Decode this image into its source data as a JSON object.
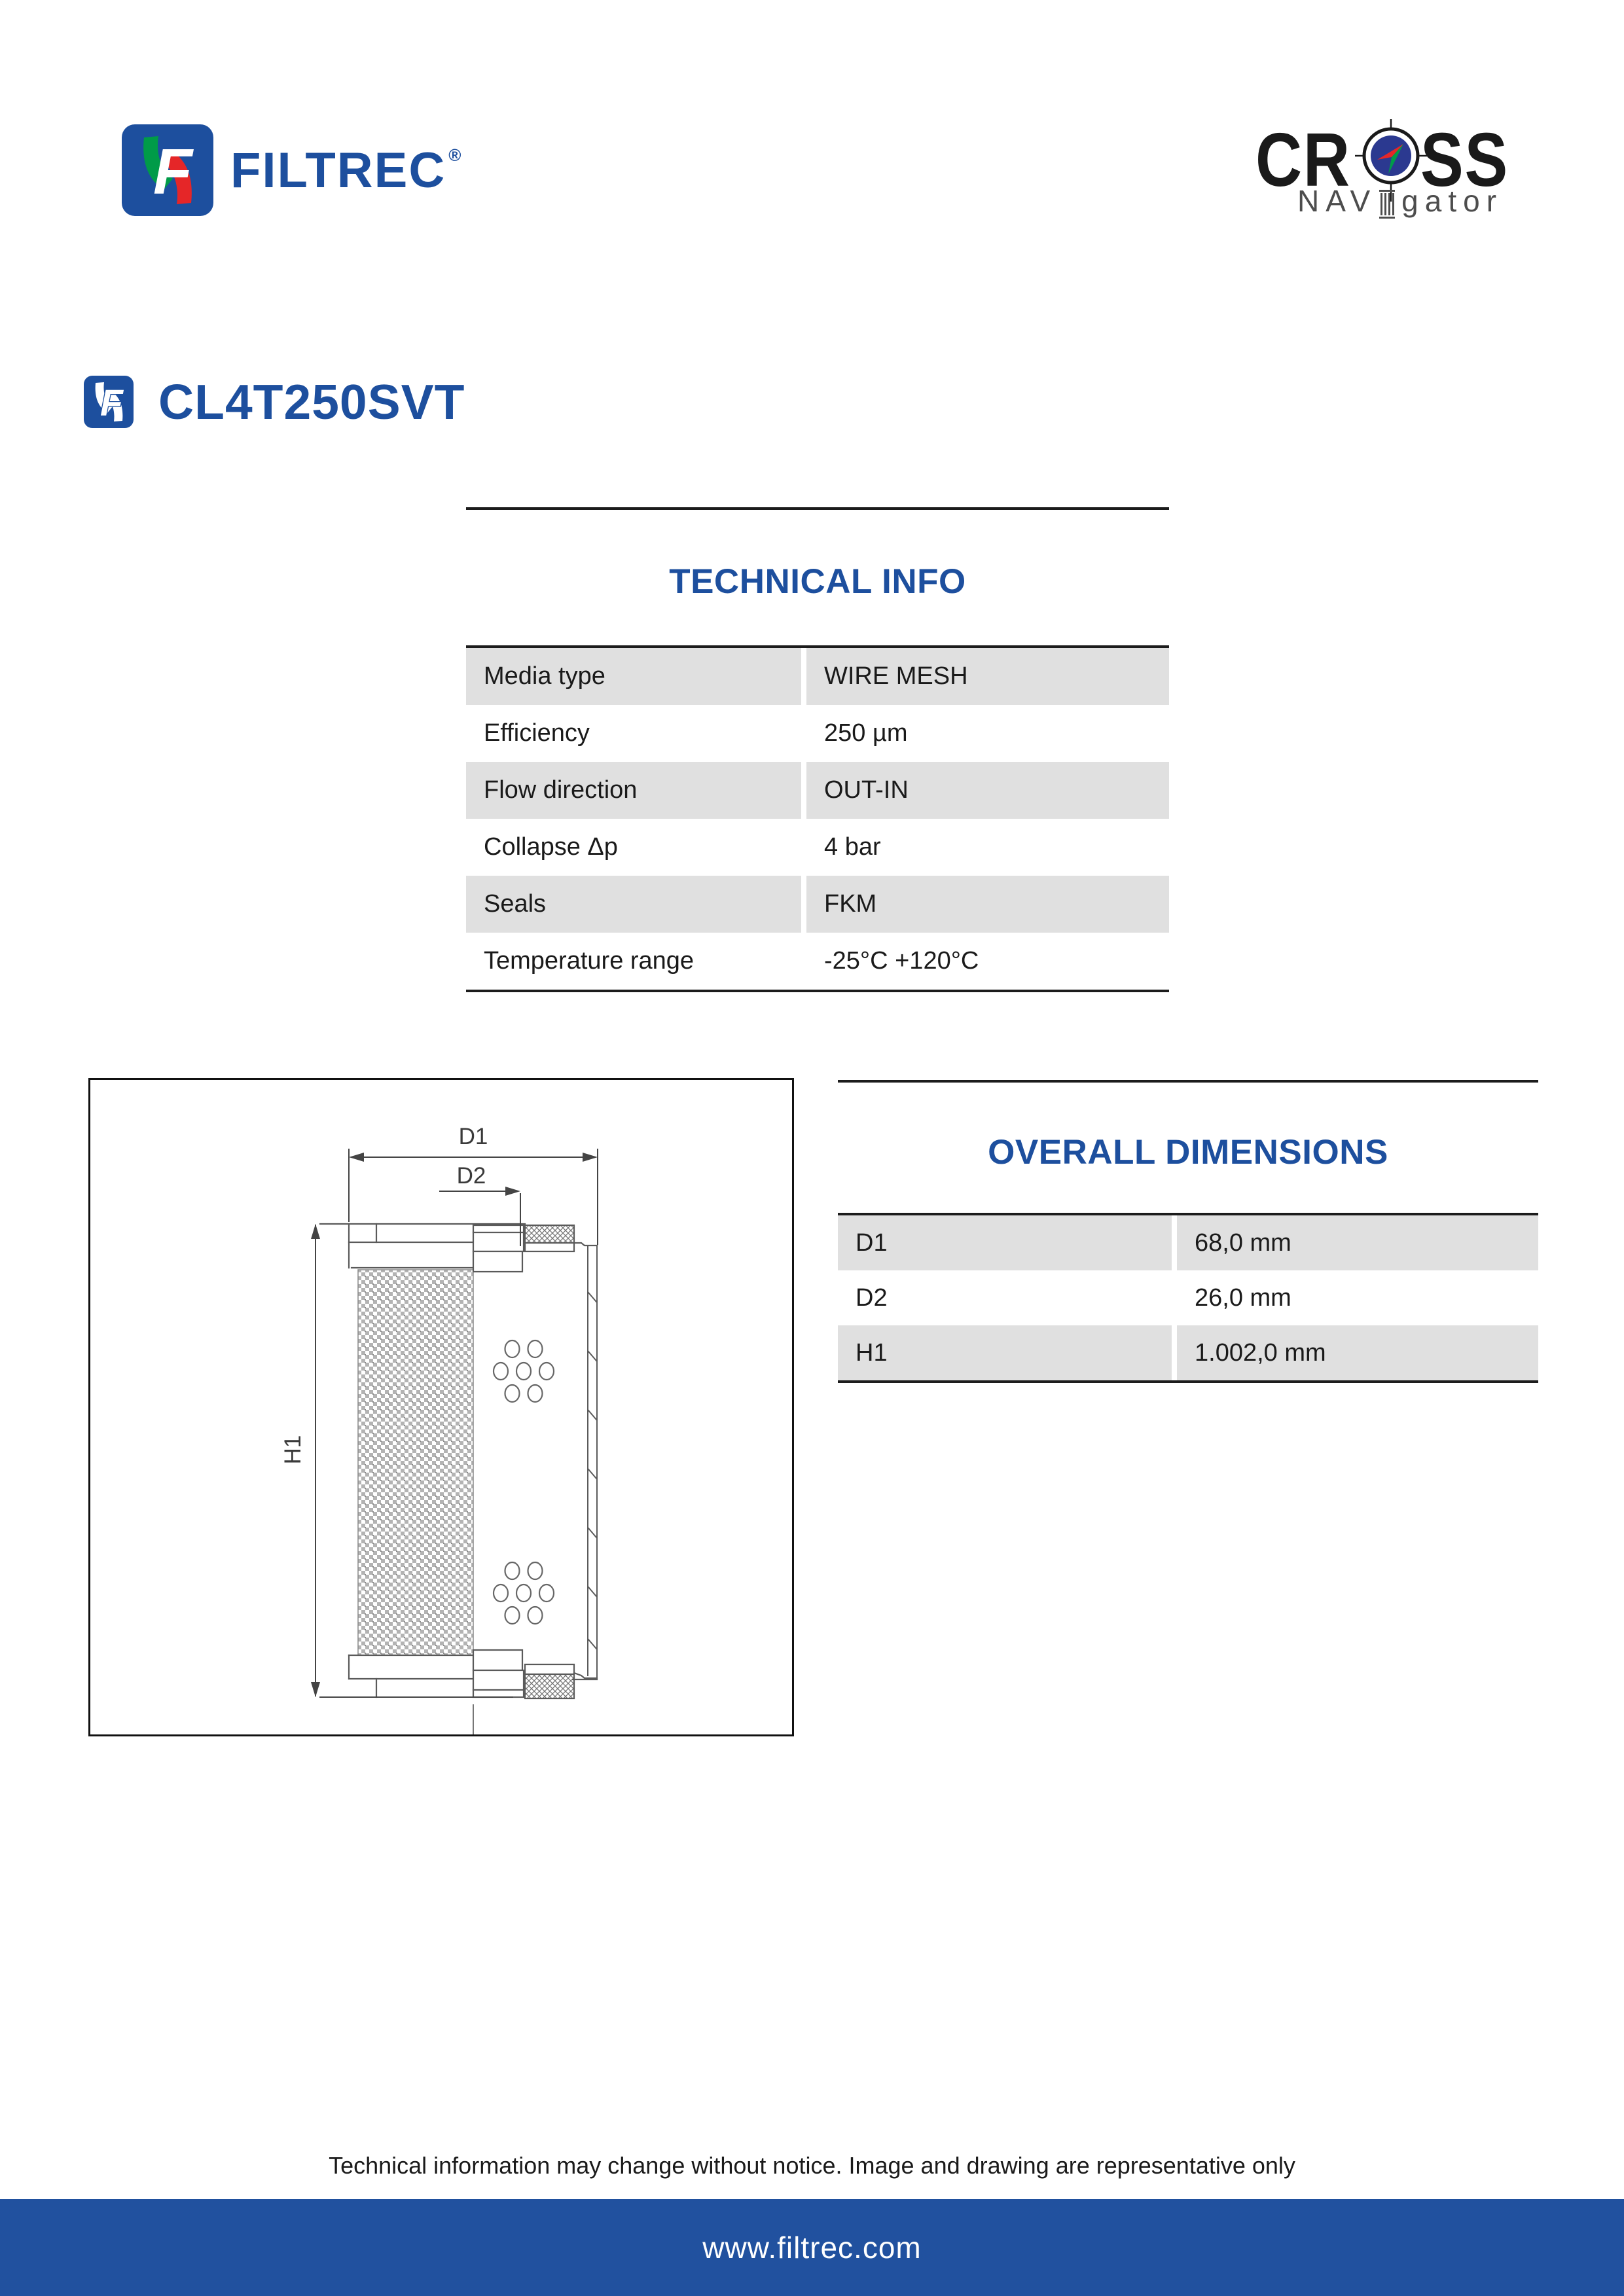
{
  "header": {
    "filtrec_logo": {
      "name": "FILTREC",
      "registered": "®"
    },
    "cross_logo": {
      "word_left": "CR",
      "word_right": "SS",
      "sub_left": "NAV",
      "sub_right": "gator"
    }
  },
  "product": {
    "code": "CL4T250SVT"
  },
  "technical_info": {
    "title": "TECHNICAL INFO",
    "rows": [
      {
        "label": "Media type",
        "value": "WIRE MESH"
      },
      {
        "label": "Efficiency",
        "value": "250 µm"
      },
      {
        "label": "Flow direction",
        "value": "OUT-IN"
      },
      {
        "label": "Collapse Δp",
        "value": "4 bar"
      },
      {
        "label": "Seals",
        "value": "FKM"
      },
      {
        "label": "Temperature range",
        "value": "-25°C +120°C"
      }
    ]
  },
  "drawing": {
    "dim_labels": {
      "d1": "D1",
      "d2": "D2",
      "h1": "H1"
    }
  },
  "overall_dimensions": {
    "title": "OVERALL DIMENSIONS",
    "rows": [
      {
        "label": "D1",
        "value": "68,0 mm"
      },
      {
        "label": "D2",
        "value": "26,0 mm"
      },
      {
        "label": "H1",
        "value": "1.002,0 mm"
      }
    ]
  },
  "footer": {
    "disclaimer": "Technical information may change without notice. Image and drawing are representative only",
    "website": "www.filtrec.com"
  },
  "colors": {
    "brand_blue": "#1d4f9e",
    "footer_bar_blue": "#21519f",
    "table_row_gray": "#e0e0e0",
    "compass_blue": "#2b3990",
    "logo_green": "#009b48",
    "logo_red": "#e52628",
    "cross_black": "#1a1a1a",
    "navigator_gray": "#4d4d4d"
  }
}
